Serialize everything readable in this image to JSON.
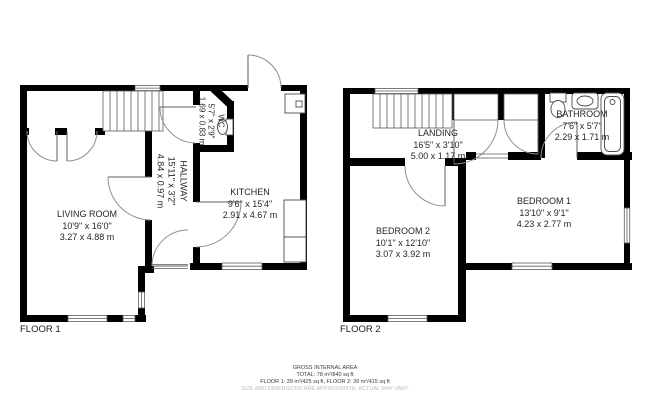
{
  "floor1": {
    "label": "FLOOR 1",
    "living_room": {
      "name": "LIVING ROOM",
      "imperial": "10'9\" x 16'0\"",
      "metric": "3.27 x 4.88 m"
    },
    "kitchen": {
      "name": "KITCHEN",
      "imperial": "9'6\" x 15'4\"",
      "metric": "2.91 x 4.67 m"
    },
    "hallway": {
      "name": "HALLWAY",
      "imperial": "15'11\" x 3'2\"",
      "metric": "4.84 x 0.97 m"
    },
    "wc": {
      "name": "WC",
      "imperial": "5'7\" x 2'9\"",
      "metric": "1.69 x 0.83 m"
    }
  },
  "floor2": {
    "label": "FLOOR 2",
    "landing": {
      "name": "LANDING",
      "imperial": "16'5\" x 3'10\"",
      "metric": "5.00 x 1.17 m"
    },
    "bathroom": {
      "name": "BATHROOM",
      "imperial": "7'6\" x 5'7\"",
      "metric": "2.29 x 1.71 m"
    },
    "bedroom1": {
      "name": "BEDROOM 1",
      "imperial": "13'10\" x 9'1\"",
      "metric": "4.23 x 2.77 m"
    },
    "bedroom2": {
      "name": "BEDROOM 2",
      "imperial": "10'1\" x 12'10\"",
      "metric": "3.07 x 3.92 m"
    }
  },
  "footer": {
    "title": "GROSS INTERNAL AREA",
    "total": "TOTAL: 78 m²/840 sq ft",
    "floors": "FLOOR 1: 39 m²/425 sq ft, FLOOR 2: 39 m²/415 sq ft",
    "disclaimer": "SIZE AND DIMENSIONS ARE APPROXIMATE, ACTUAL MAY VARY"
  },
  "colors": {
    "wall": "#000000",
    "thin_line": "#5a5a5a",
    "door_arc": "#8f8f8f",
    "text": "#262626",
    "disclaimer_text": "#bcbcbc"
  }
}
